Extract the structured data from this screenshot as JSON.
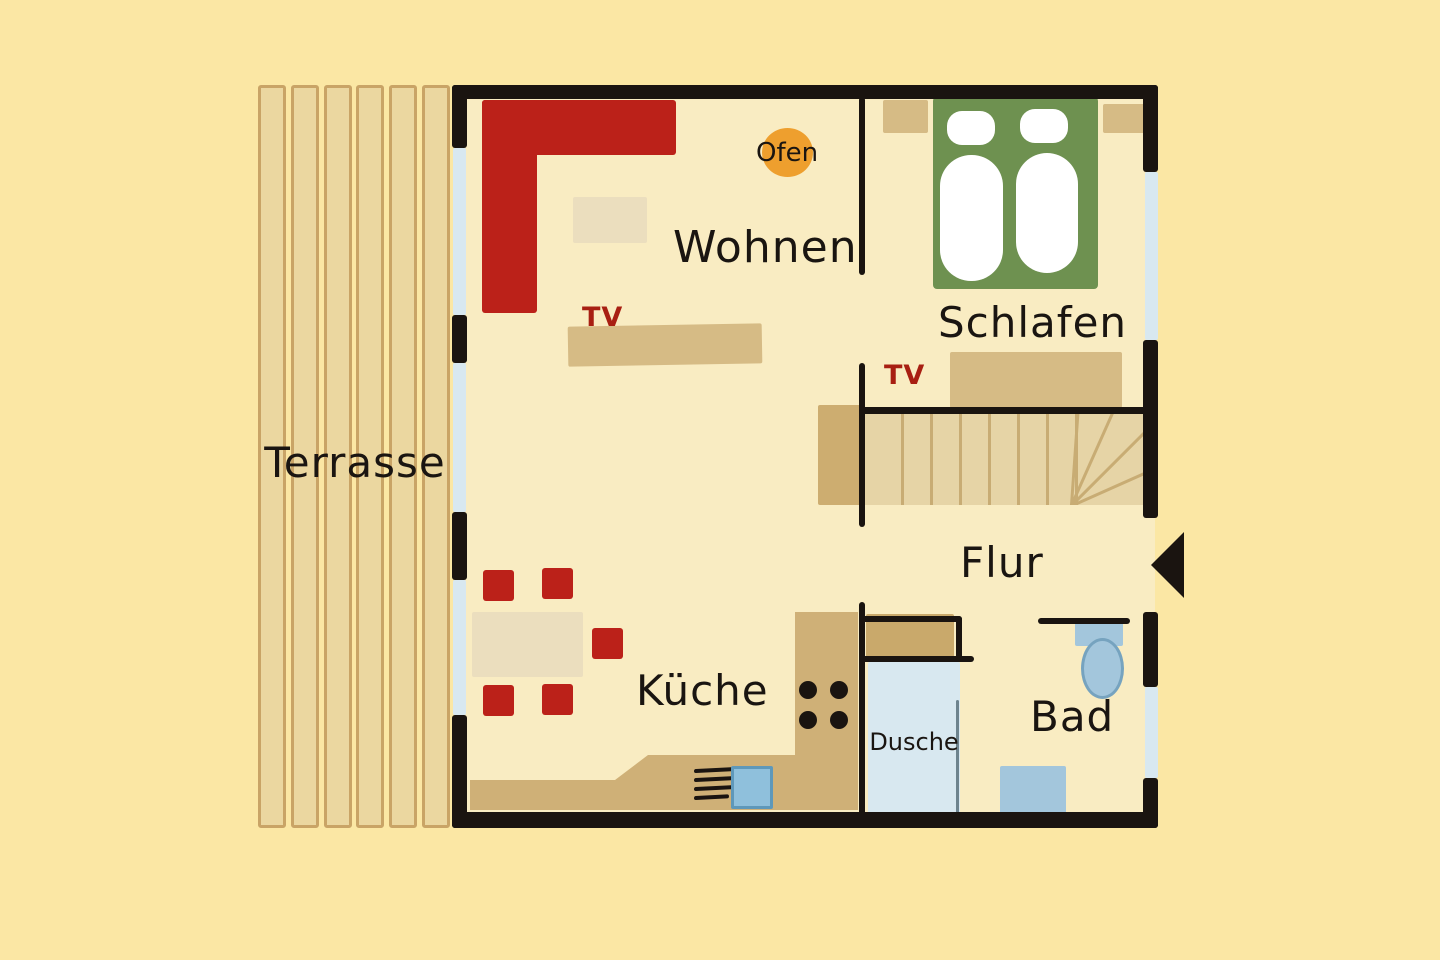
{
  "diagram": {
    "type": "floor-plan",
    "language": "de"
  },
  "labels": {
    "terrasse": "Terrasse",
    "wohnen": "Wohnen",
    "schlafen": "Schlafen",
    "flur": "Flur",
    "kueche": "Küche",
    "dusche": "Dusche",
    "bad": "Bad",
    "ofen": "Ofen",
    "tv_living": "TV",
    "tv_bedroom": "TV"
  },
  "colors": {
    "bg": "#FBE7A4",
    "floor": "#F9ECC2",
    "wall": "#1A1410",
    "window": "#D8E8F0",
    "ink": "#1A1511",
    "red": "#BB2119",
    "red-text": "#A81F12",
    "green": "#6E9150",
    "orange": "#EE9F2E",
    "tan": "#D6BB85",
    "beige": "#EBDEBE",
    "counter": "#CFB077",
    "cabinet": "#C9A96B",
    "landing": "#CDAD70",
    "stairs": "#E6D4A6",
    "stair-line": "#C8AC74",
    "plank-fill": "#EBD7A0",
    "plank-edge": "#C9A466",
    "fixture": "#A3C6DC",
    "fixture-edge": "#76A3BF",
    "sink": "#8FC0DC",
    "sink-edge": "#5E98BA"
  }
}
